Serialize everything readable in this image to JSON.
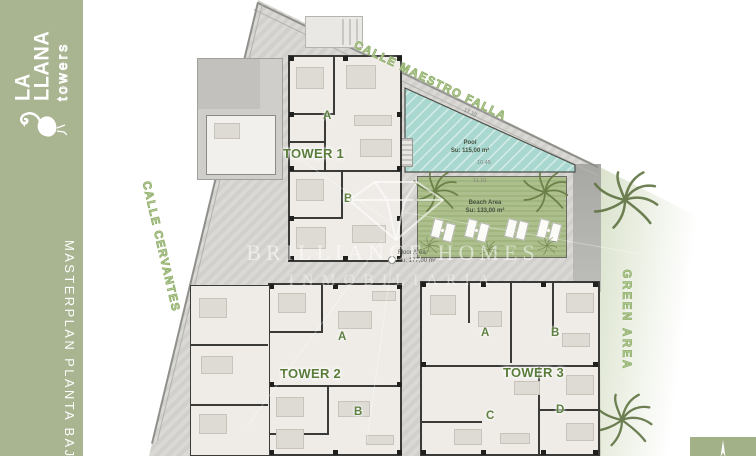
{
  "sidebar": {
    "brand": [
      "LA",
      "LLANA"
    ],
    "brand_sub": "towers",
    "title": "MASTERPLAN PLANTA BAJA"
  },
  "streets": {
    "top": "CALLE MAESTRO FALLA",
    "left": "CALLE CERVANTES"
  },
  "areas": {
    "pool": {
      "label": "Pool",
      "area": "Su: 115,00 m²"
    },
    "beach": {
      "label": "Beach Area",
      "area": "Su: 133,00 m²"
    },
    "floor": {
      "label": "Floor Area",
      "area": "Su: 177,00 m²"
    },
    "green": {
      "label": "GREEN AREA"
    }
  },
  "towers": {
    "t1": {
      "label": "TOWER 1",
      "units": [
        "A",
        "B"
      ]
    },
    "t2": {
      "label": "TOWER 2",
      "units": [
        "A",
        "B"
      ]
    },
    "t3": {
      "label": "TOWER 3",
      "units": [
        "A",
        "B",
        "C",
        "D"
      ]
    }
  },
  "watermark": {
    "line1": "BRILLIANCE HOMES",
    "line2": "INMOBILIARIA"
  },
  "dimensions": {
    "beach_top": "11.10",
    "pool_bottom": "10.45",
    "pool_slant": "17.10"
  },
  "colors": {
    "sidebar_green": "#a9b491",
    "label_green": "#597c3a",
    "street_green": "#8fae6a",
    "pool_teal": "#a9d8d0",
    "lawn_green": "#a8bc86",
    "pavement_gray": "#d8d7d3"
  }
}
